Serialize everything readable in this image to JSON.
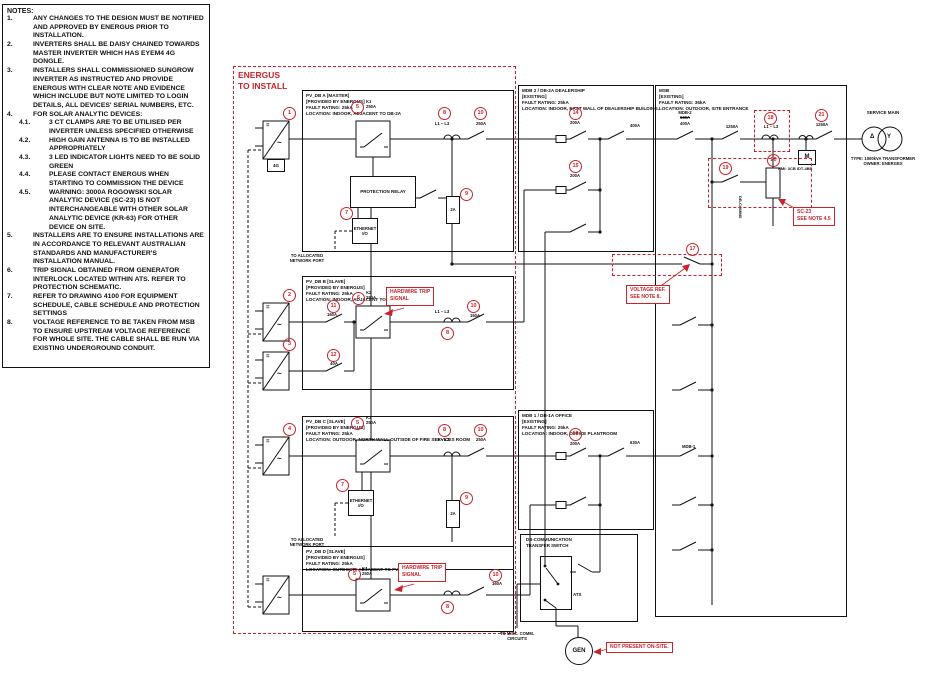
{
  "colors": {
    "red": "#c8232b",
    "line": "#111111"
  },
  "symbols": {
    "dc": "=",
    "ac": "~"
  },
  "notes": {
    "title": "NOTES:",
    "items": [
      {
        "num": "1.",
        "text": "ANY CHANGES TO THE DESIGN MUST BE NOTIFIED AND APPROVED BY ENERGUS PRIOR TO INSTALLATION.",
        "sub": false
      },
      {
        "num": "2.",
        "text": "INVERTERS SHALL BE DAISY CHAINED TOWARDS MASTER INVERTER WHICH HAS EYEM4 4G DONGLE.",
        "sub": false
      },
      {
        "num": "3.",
        "text": "INSTALLERS SHALL COMMISSIONED SUNGROW INVERTER AS INSTRUCTED AND PROVIDE ENERGUS WITH CLEAR NOTE AND EVIDENCE WHICH INCLUDE BUT NOTE LIMITED TO LOGIN DETAILS, ALL DEVICES' SERIAL NUMBERS, ETC.",
        "sub": false
      },
      {
        "num": "4.",
        "text": "FOR SOLAR ANALYTIC DEVICES:",
        "sub": false
      },
      {
        "num": "4.1.",
        "text": "3 CT CLAMPS ARE TO BE UTILISED PER INVERTER UNLESS SPECIFIED OTHERWISE",
        "sub": true
      },
      {
        "num": "4.2.",
        "text": "HIGH GAIN ANTENNA IS TO BE INSTALLED APPROPRIATELY",
        "sub": true
      },
      {
        "num": "4.3.",
        "text": "3 LED INDICATOR LIGHTS NEED TO BE SOLID GREEN",
        "sub": true
      },
      {
        "num": "4.4.",
        "text": "PLEASE CONTACT ENERGUS WHEN STARTING TO COMMISSION THE DEVICE",
        "sub": true
      },
      {
        "num": "4.5.",
        "text": "WARNING: 3000A ROGOWSKI SOLAR ANALYTIC DEVICE (SC-23) IS NOT INTERCHANGEABLE WITH OTHER SOLAR ANALYTIC DEVICE (KR-63) FOR OTHER DEVICE ON SITE.",
        "sub": true
      },
      {
        "num": "5.",
        "text": "INSTALLERS ARE TO ENSURE INSTALLATIONS ARE IN ACCORDANCE TO RELEVANT AUSTRALIAN STANDARDS AND MANUFACTURER'S INSTALLATION MANUAL.",
        "sub": false
      },
      {
        "num": "6.",
        "text": "TRIP SIGNAL OBTAINED FROM GENERATOR INTERLOCK LOCATED WITHIN ATS. REFER TO PROTECTION SCHEMATIC.",
        "sub": false
      },
      {
        "num": "7.",
        "text": "REFER TO DRAWING 4100 FOR EQUIPMENT SCHEDULE, CABLE SCHEDULE AND PROTECTION SETTINGS",
        "sub": false
      },
      {
        "num": "8.",
        "text": "VOLTAGE REFERENCE TO BE TAKEN FROM MSB TO ENSURE UPSTREAM VOLTAGE REFERENCE FOR WHOLE SITE. THE CABLE SHALL BE RUN VIA EXISTING UNDERGROUND CONDUIT.",
        "sub": false
      }
    ]
  },
  "energus": {
    "l1": "ENERGUS",
    "l2": "TO INSTALL"
  },
  "boards": {
    "pv_a": {
      "title": "PV_DB A [MASTER]",
      "provided": "[PROVIDED BY ENERGUS]",
      "fault": "FAULT RATING: 25kA",
      "location": "LOCATION: INDOOR, ADJACENT TO DB-2A",
      "inverter_tag": "1",
      "dongle": "4G",
      "contactor_tag": "5",
      "contactor_name": "K1",
      "contactor_amp": "250A",
      "relay": "PROTECTION RELAY",
      "eth_tag": "7",
      "eth_l1": "ETHERNET",
      "eth_l2": "I/O",
      "aux_tag": "9",
      "aux_label": "2A",
      "ct_tag": "8",
      "ct_label": "L1 – L3",
      "out_tag": "10",
      "out_amp": "250A",
      "net_l1": "TO ALLOCATED",
      "net_l2": "NETWORK PORT"
    },
    "pv_b": {
      "title": "PV_DB B [SLAVE]",
      "provided": "[PROVIDED BY ENERGUS]",
      "fault": "FAULT RATING: 25kA",
      "location": "LOCATION: INDOOR, ADJACENT TO DB-2A",
      "inv1_tag": "2",
      "inv2_tag": "3",
      "sw1_tag": "11",
      "sw1_amp": "160A",
      "sw2_tag": "12",
      "sw2_amp": "40A",
      "contactor_tag": "6",
      "contactor_name": "K2",
      "contactor_amp": "250A",
      "ct_tag": "8",
      "ct_label": "L1 – L3",
      "out_tag": "10",
      "out_amp": "160A"
    },
    "pv_c": {
      "title": "PV_DB C [SLAVE]",
      "provided": "[PROVIDED BY ENERGUS]",
      "fault": "FAULT RATING: 25kA",
      "location": "LOCATION: OUTDOOR, NORTH WALL OUTSIDE OF FIRE SERVICES ROOM",
      "inverter_tag": "4",
      "contactor_tag": "5",
      "contactor_name": "K3",
      "contactor_amp": "250A",
      "eth_tag": "7",
      "eth_l1": "ETHERNET",
      "eth_l2": "I/O",
      "aux_tag": "9",
      "aux_label": "2A",
      "ct_tag": "8",
      "ct_label": "L1 – L3",
      "out_tag": "10",
      "out_amp": "250A",
      "net_l1": "TO ALLOCATED",
      "net_l2": "NETWORK PORT"
    },
    "pv_d": {
      "title": "PV_DB D [SLAVE]",
      "provided": "[PROVIDED BY ENERGUS]",
      "fault": "FAULT RATING: 25kA",
      "location": "LOCATION: OUTDOOR, ADJACENT TO PV_DB C",
      "contactor_tag": "5",
      "contactor_name": "K4",
      "contactor_amp": "250A",
      "ct_tag": "8",
      "out_tag": "10",
      "out_amp": "160A"
    },
    "mdb2": {
      "title": "MDB 2 / DB-2A DEALERSHIP",
      "existing": "[EXISTING]",
      "fault": "FAULT RATING: 25kA",
      "location": "LOCATION: INDOOR, EAST WALL OF DEALERSHIP BUILDING.",
      "f1_tag": "14",
      "f1_amp": "200A",
      "sw_right_amp": "400A",
      "f2_tag": "15",
      "f2_amp": "200A"
    },
    "mdb1": {
      "title": "MDB 1 / DB-1A OFFICE",
      "existing": "[EXISTING]",
      "fault": "FAULT RATING: 25kA",
      "location": "LOCATION: INDOOR, OFFICE PLANTROOM",
      "f1_tag": "16",
      "f1_amp": "200A",
      "sw_right_amp": "630A"
    },
    "msb": {
      "title": "MSB",
      "existing": "[EXISTING]",
      "fault": "FAULT RATING: 36kA",
      "location": "LOCATION: OUTDOOR, SITE ENTRANCE",
      "mdb2_name": "MDB-2",
      "mdb2_old": "630A",
      "mdb2_new": "400A",
      "iso_amp": "1250A",
      "ct18_tag": "18",
      "ct18_label": "L1 – L3",
      "sw19_tag": "19",
      "ct20_tag": "20",
      "vref_tag": "17",
      "main_tag": "21",
      "main_amp": "1250A",
      "meter": "M",
      "meter_note": "NMI: 3CB IDT-4BB",
      "mdb1_name": "MDB-1",
      "dbcomms": "DB-COMMS"
    }
  },
  "service": {
    "label": "SERVICE MAIN",
    "type_line": "TYPE: 1000kVA TRANSFORMER",
    "owner_line": "OWNER: ENERGEX",
    "primary": "Δ",
    "secondary": "Y"
  },
  "ats": {
    "l1": "DB-COMMUNICATION",
    "l2": "TRANSFER SWITCH",
    "device": "ATS",
    "gen": "GEN",
    "misc_l1": "TO MISC. COMM.",
    "misc_l2": "CIRCUITS"
  },
  "labels": {
    "trip_l1": "HARDWIRE TRIP",
    "trip_l2": "SIGNAL",
    "vref_l1": "VOLTAGE REF.",
    "vref_l2": "SEE NOTE 8.",
    "sc23_l1": "SC-23",
    "sc23_l2": "SEE NOTE 4.5",
    "not_present": "NOT PRESENT ON-SITE."
  }
}
